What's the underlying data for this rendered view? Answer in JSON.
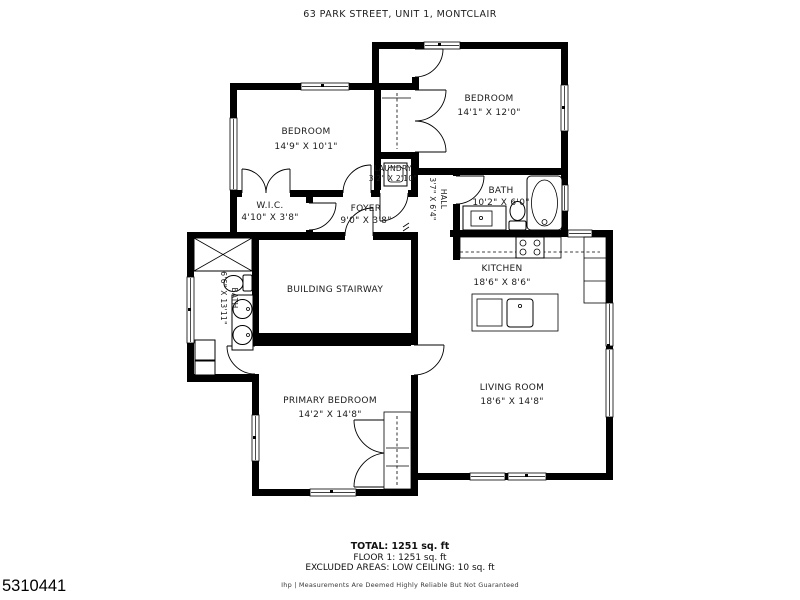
{
  "title": "63 PARK STREET, UNIT 1, MONTCLAIR",
  "rooms": {
    "bedroom1": {
      "name": "BEDROOM",
      "dims": "14'9\" X 10'1\""
    },
    "bedroom2": {
      "name": "BEDROOM",
      "dims": "14'1\" X 12'0\""
    },
    "laundry": {
      "name": "LAUNDRY",
      "dims": "3'2\" X 2'10\""
    },
    "hall": {
      "name": "HALL",
      "dims": "3'7\" X 6'4\""
    },
    "bath1": {
      "name": "BATH",
      "dims": "10'2\" X 6'0\""
    },
    "wic": {
      "name": "W.I.C.",
      "dims": "4'10\" X 3'8\""
    },
    "foyer": {
      "name": "FOYER",
      "dims": "9'0\" X 3'8\""
    },
    "kitchen": {
      "name": "KITCHEN",
      "dims": "18'6\" X 8'6\""
    },
    "stairway": {
      "name": "BUILDING STAIRWAY",
      "dims": ""
    },
    "bath2": {
      "name": "BATH",
      "dims": "6'6\" X 13'11\""
    },
    "primary_bedroom": {
      "name": "PRIMARY BEDROOM",
      "dims": "14'2\" X 14'8\""
    },
    "living_room": {
      "name": "LIVING ROOM",
      "dims": "18'6\" X 14'8\""
    }
  },
  "footer": {
    "total": "TOTAL: 1251 sq. ft",
    "floor": "FLOOR 1: 1251 sq. ft",
    "excluded": "EXCLUDED AREAS: LOW CEILING: 10 sq. ft",
    "disclaimer": "Ihp | Measurements Are Deemed Highly Reliable But Not Guaranteed",
    "listing_id": "5310441"
  },
  "colors": {
    "wall": "#000000",
    "background": "#ffffff",
    "text": "#1b1b1b"
  }
}
